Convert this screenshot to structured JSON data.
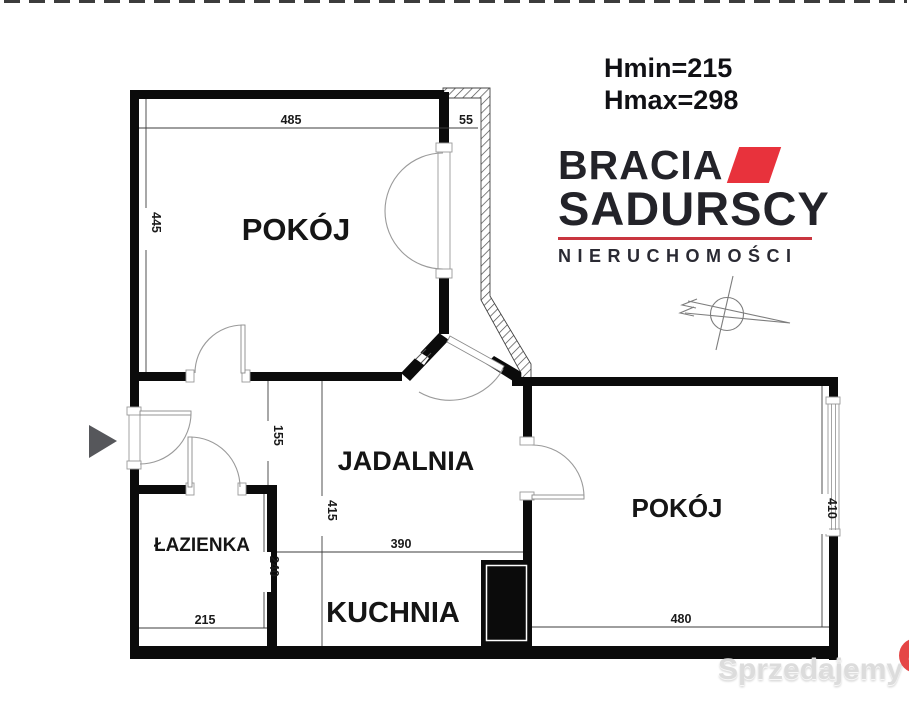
{
  "header": {
    "hmin": "Hmin=215",
    "hmax": "Hmax=298"
  },
  "logo": {
    "brand_line1": "BRACIA",
    "brand_line2": "SADURSCY",
    "tagline": "NIERUCHOMOŚCI",
    "accent_color": "#e8323c",
    "underline_color": "#c9353f",
    "text_color": "#232329"
  },
  "floor_plan": {
    "rooms": {
      "room_top_left": "POKÓJ",
      "dining": "JADALNIA",
      "room_right": "POKÓJ",
      "bathroom": "ŁAZIENKA",
      "kitchen": "KUCHNIA"
    },
    "dims": {
      "w485": "485",
      "w55": "55",
      "h445": "445",
      "h155": "155",
      "h415": "415",
      "w390": "390",
      "h240": "240",
      "w215": "215",
      "h410": "410",
      "w480": "480"
    },
    "wall_color": "#0b0b0b",
    "line_color": "#3d3d3d",
    "entrance_arrow_color": "#56575b"
  },
  "watermark": {
    "name": "Sprzedajemy",
    "suffix": ".pl",
    "badge_color": "#e54545",
    "text_color": "#dcdcdc"
  }
}
